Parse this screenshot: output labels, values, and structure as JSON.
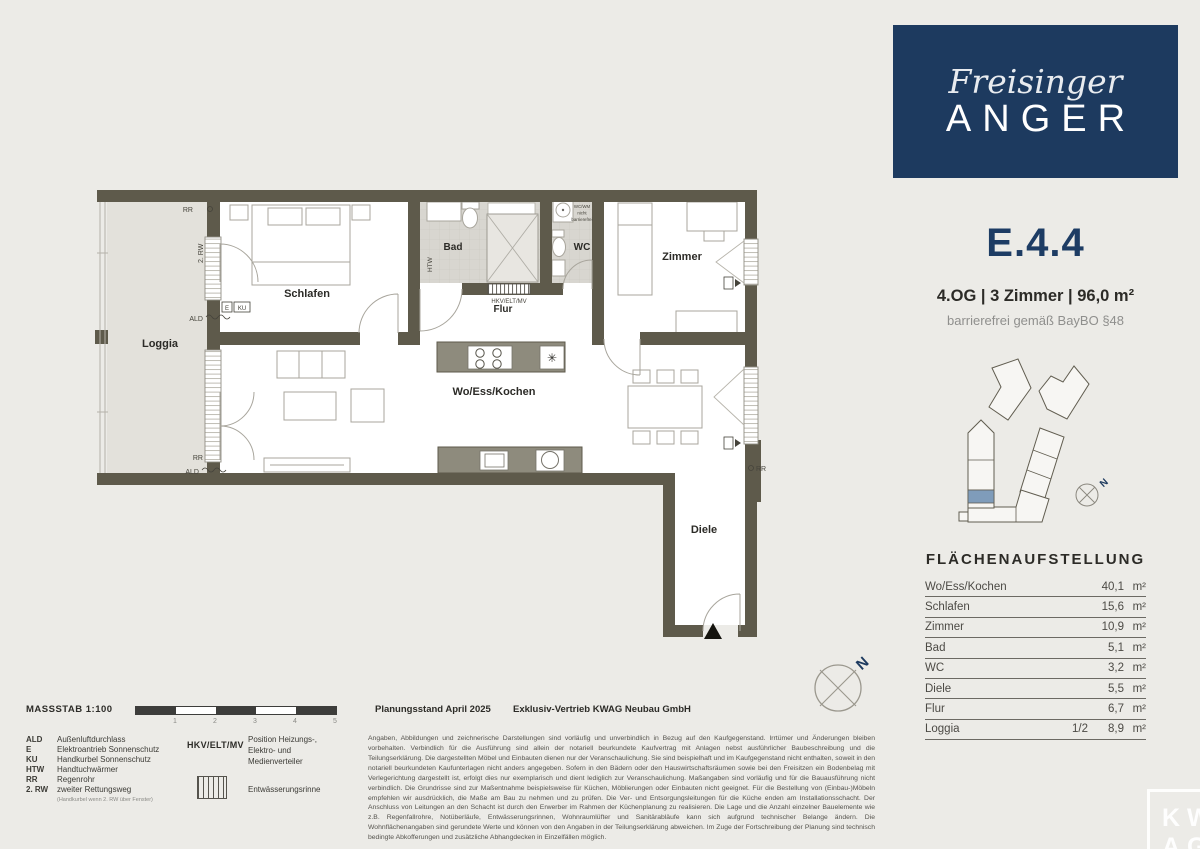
{
  "brand": {
    "script": "Freisinger",
    "caps": "ANGER"
  },
  "unit": {
    "id": "E.4.4",
    "info": "4.OG  |  3 Zimmer  |  96,0 m²",
    "note": "barrierefrei gemäß BayBO §48"
  },
  "area_table": {
    "title": "FLÄCHENAUFSTELLUNG",
    "rows": [
      {
        "label": "Wo/Ess/Kochen",
        "fraction": "",
        "value": "40,1",
        "unit": "m²"
      },
      {
        "label": "Schlafen",
        "fraction": "",
        "value": "15,6",
        "unit": "m²"
      },
      {
        "label": "Zimmer",
        "fraction": "",
        "value": "10,9",
        "unit": "m²"
      },
      {
        "label": "Bad",
        "fraction": "",
        "value": "5,1",
        "unit": "m²"
      },
      {
        "label": "WC",
        "fraction": "",
        "value": "3,2",
        "unit": "m²"
      },
      {
        "label": "Diele",
        "fraction": "",
        "value": "5,5",
        "unit": "m²"
      },
      {
        "label": "Flur",
        "fraction": "",
        "value": "6,7",
        "unit": "m²"
      },
      {
        "label": "Loggia",
        "fraction": "1/2",
        "value": "8,9",
        "unit": "m²"
      }
    ]
  },
  "plan": {
    "rooms": {
      "loggia": "Loggia",
      "schlafen": "Schlafen",
      "bad": "Bad",
      "wc": "WC",
      "zimmer": "Zimmer",
      "flur": "Flur",
      "wohnen": "Wo/Ess/Kochen",
      "diele": "Diele"
    },
    "annotations": {
      "rro": "RR",
      "rw2": "2. RW",
      "ald_top": "ALD",
      "e_box": "E",
      "ku_box": "KU",
      "htw": "HTW",
      "rr_bottom": "RR",
      "ald_bottom": "ALD",
      "rr_right": "RR",
      "hkv": "HKV/ELT/MV",
      "wcwm_1": "WC/WM",
      "wcwm_2": "nicht",
      "wcwm_3": "barrierefrei"
    },
    "north": "N"
  },
  "site_plan": {
    "north": "N"
  },
  "legend": {
    "massstab": "MASSSTAB 1:100",
    "scale_ticks": [
      "1",
      "2",
      "3",
      "4",
      "5"
    ],
    "items": [
      {
        "abbr": "ALD",
        "desc": "Außenluftdurchlass"
      },
      {
        "abbr": "E",
        "desc": "Elektroantrieb Sonnenschutz"
      },
      {
        "abbr": "KU",
        "desc": "Handkurbel Sonnenschutz"
      },
      {
        "abbr": "HTW",
        "desc": "Handtuchwärmer"
      },
      {
        "abbr": "RR",
        "desc": "Regenrohr"
      },
      {
        "abbr": "2. RW",
        "desc": "zweiter Rettungsweg"
      }
    ],
    "rw_note": "(Handkurbel wenn 2. RW über Fenster)",
    "hkv": {
      "label": "HKV/ELT/MV",
      "desc1": "Position Heizungs-,",
      "desc2": "Elektro- und",
      "desc3": "Medienverteiler"
    },
    "rinne": "Entwässerungsrinne"
  },
  "footer": {
    "status": "Planungsstand April 2025",
    "vendor": "Exklusiv-Vertrieb  KWAG Neubau GmbH",
    "disclaimer": "Angaben, Abbildungen und zeichnerische Darstellungen sind vorläufig und unverbindlich in Bezug auf den Kaufgegenstand. Irrtümer und Änderungen bleiben vorbehalten. Verbindlich für die Ausführung sind allein der notariell beurkundete Kaufvertrag mit Anlagen nebst ausführlicher Baubeschreibung und die Teilungserklärung. Die dargestellten Möbel und Einbauten dienen nur der Veranschaulichung. Sie sind beispielhaft und im Kaufgegenstand nicht enthalten, soweit in den notariell beurkundeten Kaufunterlagen nicht anders angegeben. Sofern in den Bädern oder den Hauswirtschaftsräumen sowie bei den Freisitzen ein Bodenbelag mit Verlegerichtung dargestellt ist, erfolgt dies nur exemplarisch und dient lediglich zur Veranschaulichung. Maßangaben sind vorläufig und für die Bauausführung nicht verbindlich. Die Grundrisse sind zur Maßentnahme beispielsweise für Küchen, Möblierungen oder Einbauten nicht geeignet. Für die Bestellung von (Einbau-)Möbeln empfehlen wir ausdrücklich, die Maße am Bau zu nehmen und zu prüfen. Die Ver- und Entsorgungsleitungen für die Küche enden am Installationsschacht. Der Anschluss von Leitungen an den Schacht ist durch den Erwerber im Rahmen der Küchenplanung zu realisieren. Die Lage und die Anzahl einzelner Bauelemente wie z.B. Regenfallrohre, Notüberläufe, Entwässerungsrinnen, Wohnraumlüfter und Sanitärabläufe kann sich aufgrund technischer Belange ändern. Die Wohnflächenangaben sind gerundete Werte und können von den Angaben in der Teilungserklärung abweichen. Im Zuge der Fortschreibung der Planung sind technisch bedingte Abkofferungen und zusätzliche Abhangdecken in Einzelfällen möglich."
  },
  "watermark": {
    "line1": "KW",
    "line2": "AG"
  },
  "colors": {
    "navy": "#1d3a5f",
    "wall": "#5e5a4b",
    "page_bg": "#ecebe7",
    "loggia_fill": "#e3e1db",
    "site_highlight": "#7f9cba"
  }
}
